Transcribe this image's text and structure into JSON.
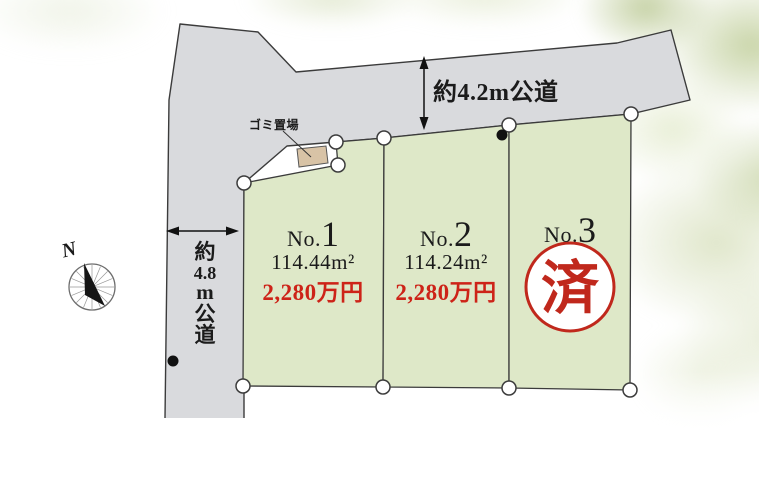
{
  "diagram": {
    "compass_label": "N",
    "roads": {
      "top": {
        "label": "約4.2m公道"
      },
      "left": {
        "label": "約4.8m公道",
        "label_chars": [
          "約",
          "4.8",
          "m",
          "公",
          "道"
        ]
      }
    },
    "garbage": {
      "label": "ゴミ置場"
    },
    "plots": [
      {
        "no_prefix": "No.",
        "no_number": "1",
        "area": "114.44m²",
        "price": "2,280万円"
      },
      {
        "no_prefix": "No.",
        "no_number": "2",
        "area": "114.24m²",
        "price": "2,280万円"
      },
      {
        "no_prefix": "No.",
        "no_number": "3",
        "status": "済"
      }
    ],
    "colors": {
      "road_fill": "#d9dadd",
      "plot_fill": "#dee8c8",
      "garbage_fill": "#d8c3a6",
      "outline": "#3b3b3b",
      "price_red": "#cd2318",
      "stamp_red": "#c0281c",
      "marker_fill": "#ffffff"
    }
  }
}
